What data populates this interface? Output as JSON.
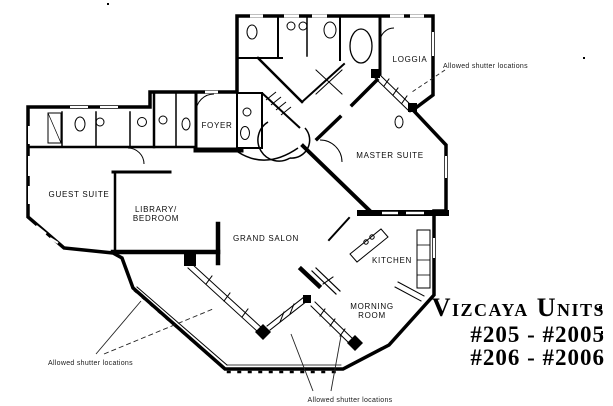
{
  "palette": {
    "room_fill": "#ff10ef",
    "wall": "#000000",
    "background": "#ffffff",
    "ink": "#1a1a1a"
  },
  "floor_plan": {
    "rooms": {
      "guest_suite": "GUEST SUITE",
      "library_line1": "LIBRARY/",
      "library_line2": "BEDROOM",
      "foyer": "FOYER",
      "grand_salon": "GRAND SALON",
      "master_suite": "MASTER SUITE",
      "loggia": "LOGGIA",
      "kitchen": "KITCHEN",
      "morning_line1": "MORNING",
      "morning_line2": "ROOM"
    },
    "annotations": {
      "top_right": "Allowed shutter locations",
      "bottom_left": "Allowed shutter locations",
      "bottom_center": "Allowed shutter locations"
    }
  },
  "title_block": {
    "name": "Vizcaya Units",
    "units_line1": "#205 - #2005",
    "units_line2": "#206 - #2006"
  }
}
